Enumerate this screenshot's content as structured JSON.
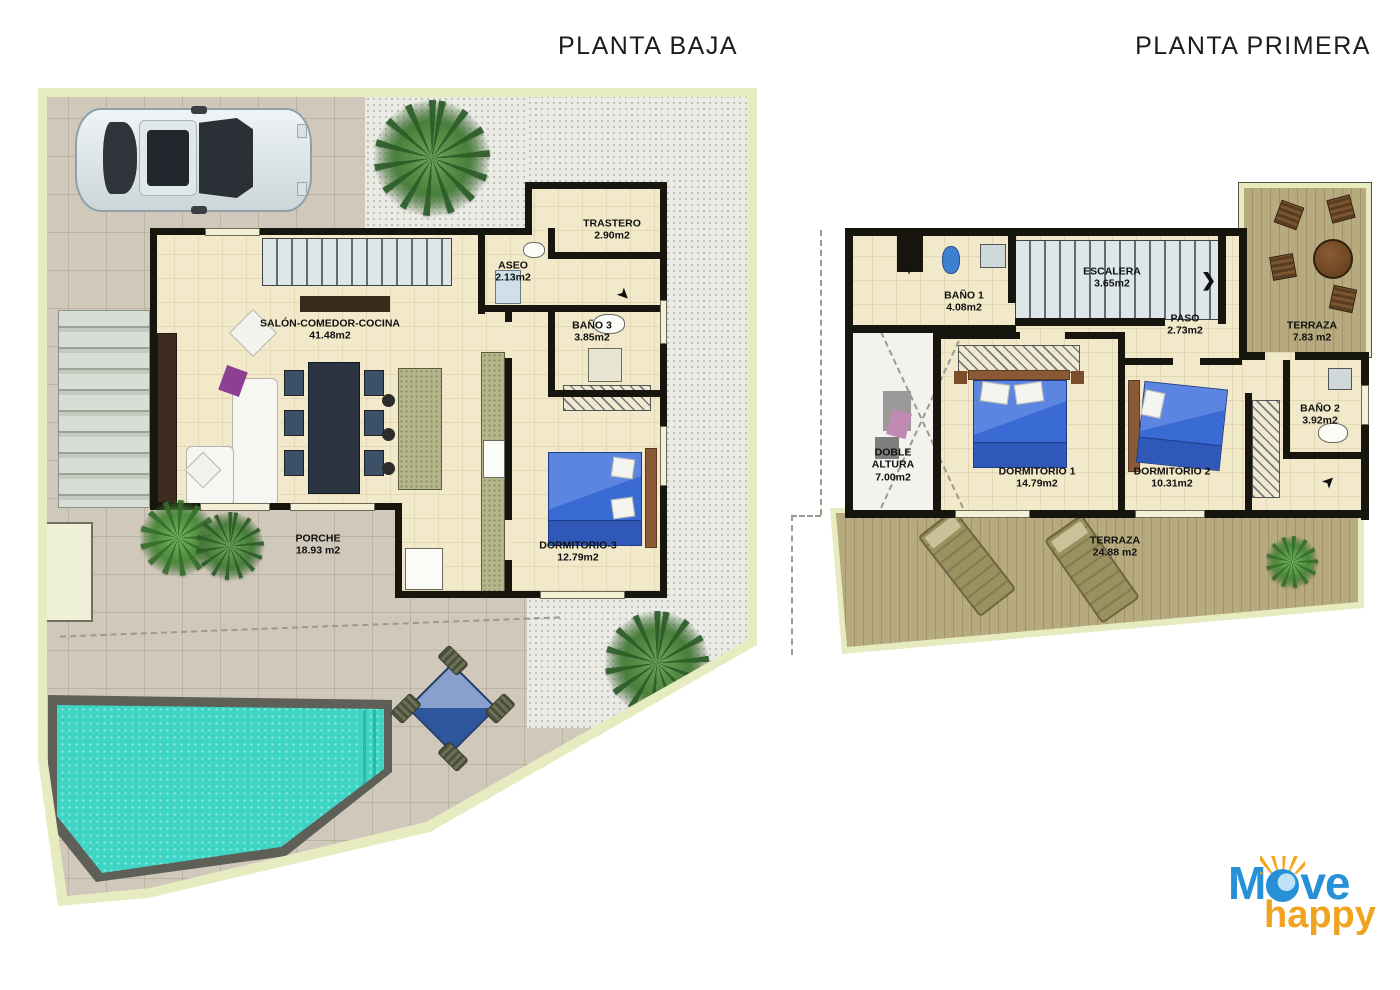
{
  "ground_floor": {
    "title": "PLANTA BAJA",
    "rooms": {
      "salon": {
        "name": "SALÓN-COMEDOR-COCINA",
        "area": "41.48m2"
      },
      "trastero": {
        "name": "TRASTERO",
        "area": "2.90m2"
      },
      "aseo": {
        "name": "ASEO",
        "area": "2.13m2"
      },
      "bano3": {
        "name": "BAÑO 3",
        "area": "3.85m2"
      },
      "dormitorio3": {
        "name": "DORMITORIO-3",
        "area": "12.79m2"
      },
      "porche": {
        "name": "PORCHE",
        "area": "18.93 m2"
      }
    }
  },
  "first_floor": {
    "title": "PLANTA PRIMERA",
    "rooms": {
      "bano1": {
        "name": "BAÑO 1",
        "area": "4.08m2"
      },
      "escalera": {
        "name": "ESCALERA",
        "area": "3.65m2"
      },
      "paso": {
        "name": "PASO",
        "area": "2.73m2"
      },
      "terraza_alta": {
        "name": "TERRAZA",
        "area": "7.83 m2"
      },
      "doble_altura": {
        "name": "DOBLE ALTURA",
        "area": "7.00m2"
      },
      "dormitorio1": {
        "name": "DORMITORIO 1",
        "area": "14.79m2"
      },
      "dormitorio2": {
        "name": "DORMITORIO 2",
        "area": "10.31m2"
      },
      "bano2": {
        "name": "BAÑO 2",
        "area": "3.92m2"
      },
      "terraza_baja": {
        "name": "TERRAZA",
        "area": "24.88 m2"
      }
    }
  },
  "logo": {
    "part1": "M",
    "part2": "ve",
    "word2": "happy"
  },
  "icons": {
    "entry_arrow": "➤",
    "stair_arrow": "❯"
  },
  "colors": {
    "pool_water": "#3fd5c5",
    "wall": "#16160e",
    "plot_band": "#e7ecc0",
    "interior_floor": "#f1e9ca",
    "deck_wood": "#b6aa7e",
    "bed_blue": "#3a6bd4",
    "logo_blue": "#2791d8",
    "logo_orange": "#efa31f"
  }
}
